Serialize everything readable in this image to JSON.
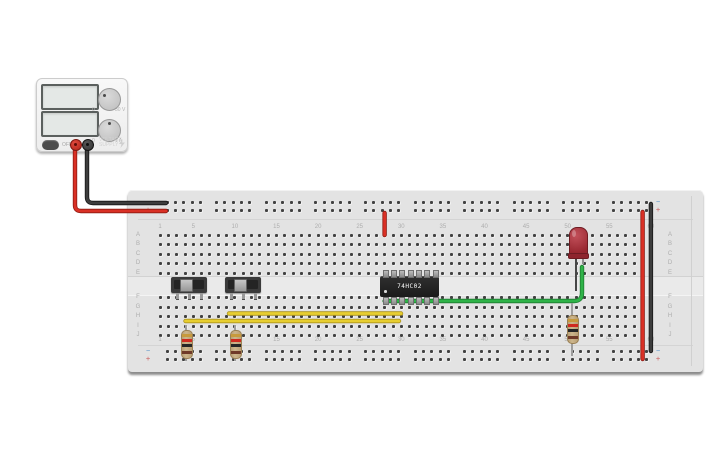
{
  "power_supply": {
    "type_label": {
      "line1": "VOLTAGE",
      "line2": "SUPPLY"
    },
    "power_button_label": "OFF",
    "display_top_value": "",
    "display_bottom_value": "",
    "voltage_knob": {
      "min_label": "0",
      "max_label": "30 V"
    },
    "current_knob": {
      "min_label": "0",
      "max_label": "1 A"
    },
    "positive_terminal_color": "#b02318",
    "negative_terminal_color": "#3d3d3d"
  },
  "breadboard": {
    "row_letters_top": [
      "A",
      "B",
      "C",
      "D",
      "E"
    ],
    "row_letters_bottom": [
      "F",
      "G",
      "H",
      "I",
      "J"
    ],
    "column_numbers": [
      "1",
      "5",
      "10",
      "15",
      "20",
      "25",
      "30",
      "35",
      "40",
      "45",
      "50",
      "55",
      "60"
    ],
    "rail_minus_label": "−",
    "rail_plus_label": "+",
    "columns": 60
  },
  "components": {
    "ic": {
      "label": "74HC02",
      "pins_per_side": 7
    },
    "switches": [
      {
        "name": "slide-switch-1"
      },
      {
        "name": "slide-switch-2"
      }
    ],
    "resistors": [
      {
        "name": "resistor-1",
        "bands_top_to_bottom": [
          "gold",
          "red",
          "black",
          "brown"
        ]
      },
      {
        "name": "resistor-2",
        "bands_top_to_bottom": [
          "gold",
          "red",
          "black",
          "brown"
        ]
      },
      {
        "name": "resistor-3",
        "bands_top_to_bottom": [
          "gold",
          "red",
          "black",
          "brown"
        ]
      }
    ],
    "led": {
      "color": "red"
    }
  },
  "wires": {
    "supply_positive": {
      "color_name": "red",
      "main": "#d93025",
      "edge": "#8e1a12"
    },
    "supply_negative": {
      "color_name": "black",
      "main": "#3d3d3d",
      "edge": "#161616"
    },
    "mid_rail_jumper": {
      "color_name": "red",
      "main": "#d93025",
      "edge": "#8e1a12"
    },
    "right_negative_jumper": {
      "color_name": "black",
      "main": "#3d3d3d",
      "edge": "#161616"
    },
    "right_positive_jumper": {
      "color_name": "red",
      "main": "#d93025",
      "edge": "#8e1a12"
    },
    "input_jumper_upper": {
      "color_name": "yellow",
      "main": "#e7ce30",
      "edge": "#ab931c"
    },
    "input_jumper_lower": {
      "color_name": "yellow",
      "main": "#e7ce30",
      "edge": "#ab931c"
    },
    "led_signal": {
      "color_name": "green",
      "main": "#2fb348",
      "edge": "#1d7c30"
    }
  }
}
